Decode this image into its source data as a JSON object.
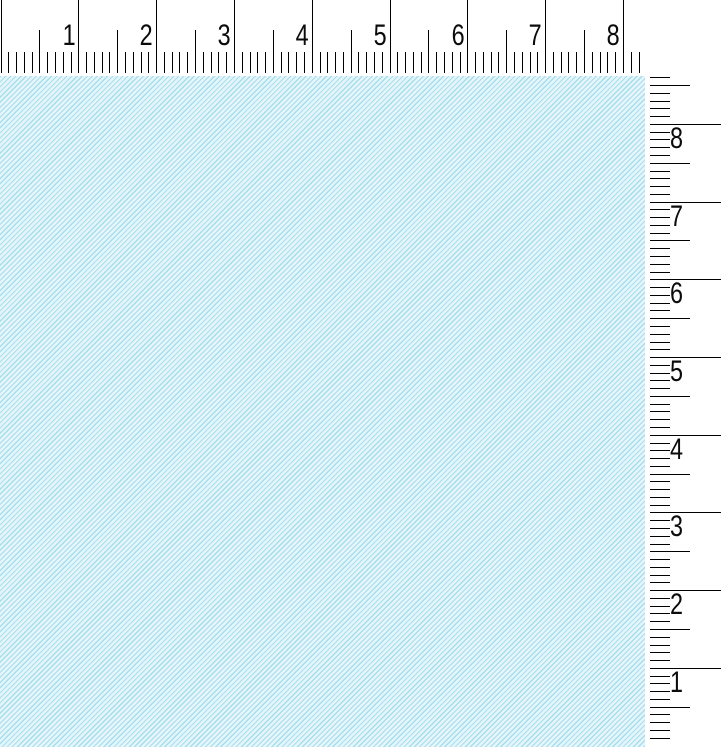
{
  "app": {
    "description": "Blank pattern canvas with top and right measurement rulers",
    "background_color": "#ffffff"
  },
  "rulers": {
    "tick_color": "#000000",
    "label_color": "#0b0b0d",
    "horizontal": {
      "side": "top",
      "labels": [
        "1",
        "2",
        "3",
        "4",
        "5",
        "6",
        "7",
        "8"
      ],
      "origin_px": 0.5,
      "unit_px": 77.8,
      "minor_per_unit": 10,
      "max_minor_index": 82
    },
    "vertical": {
      "side": "right",
      "labels": [
        "8",
        "7",
        "6",
        "5",
        "4",
        "3",
        "2",
        "1"
      ],
      "origin_px": 745.5,
      "unit_px": 77.7,
      "minor_per_unit": 10,
      "max_minor_index": 86
    }
  },
  "canvas": {
    "base_color": "#e7f5fa",
    "hatch_color": "#a4dfee",
    "pattern": "diagonal-weave"
  }
}
